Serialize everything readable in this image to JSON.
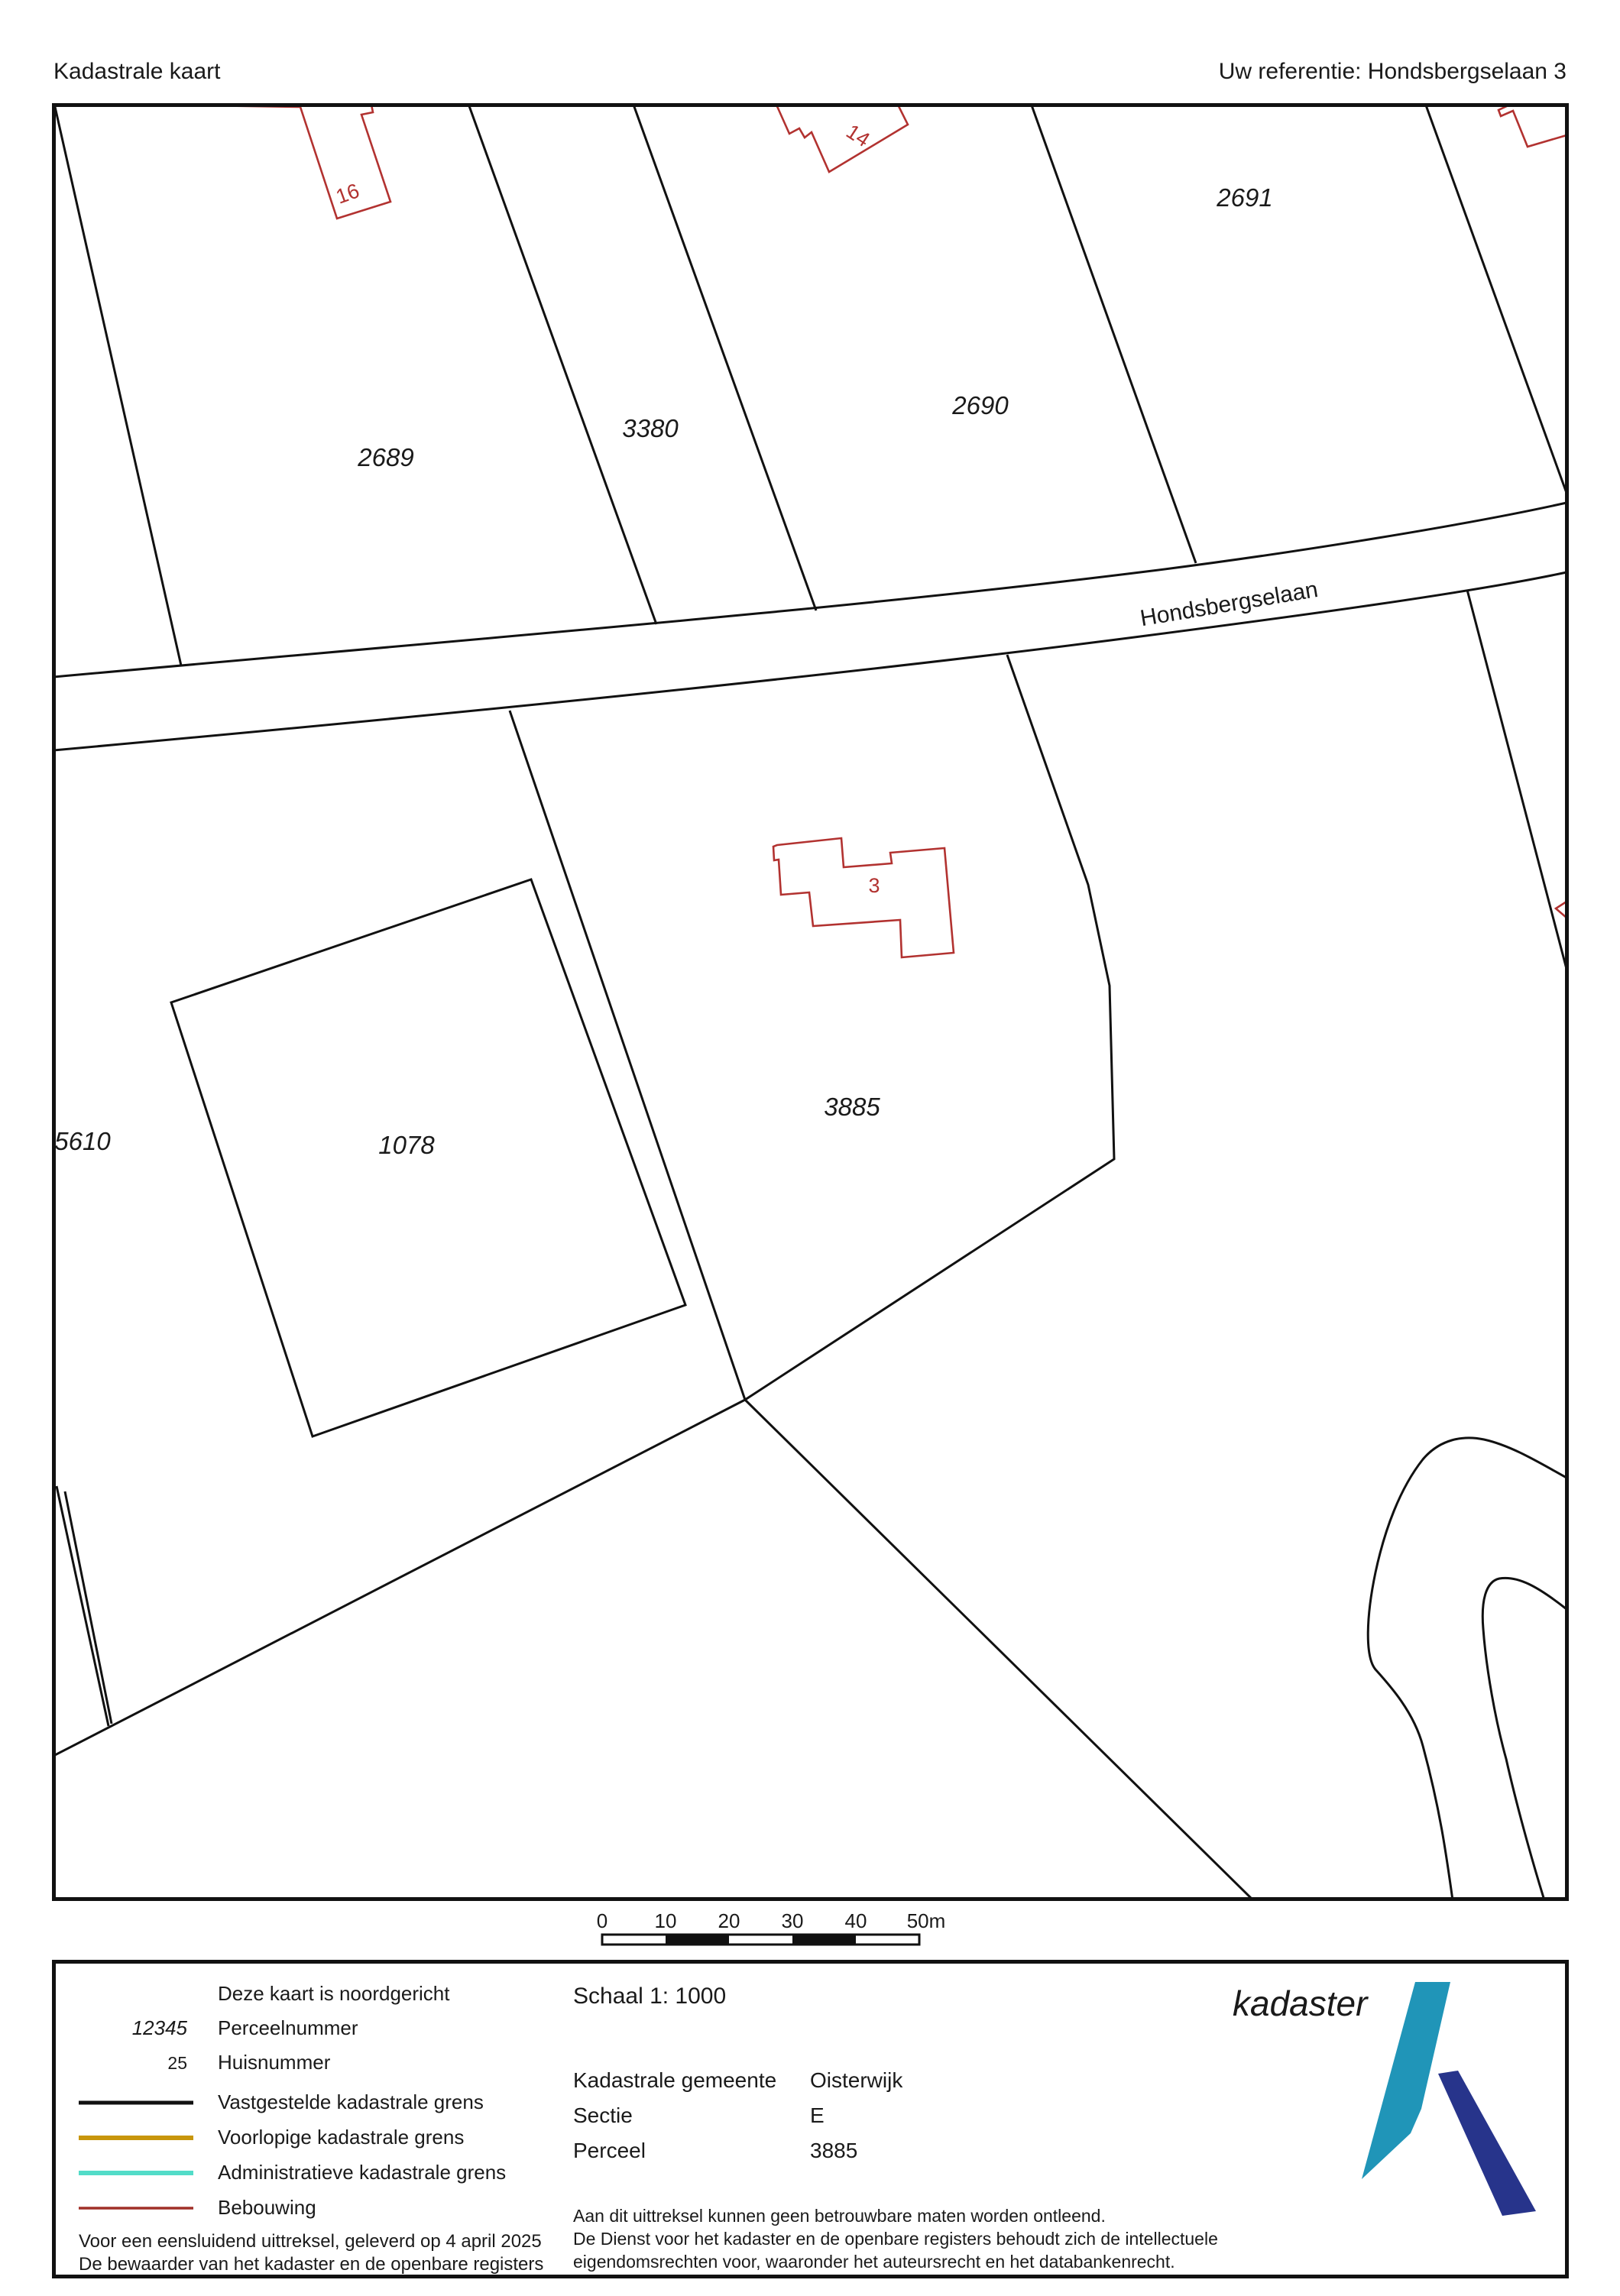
{
  "header": {
    "title": "Kadastrale kaart",
    "reference": "Uw referentie: Hondsbergselaan 3"
  },
  "map": {
    "road_label": "Hondsbergselaan",
    "parcels": [
      "2689",
      "3380",
      "2690",
      "2691",
      "3885",
      "1078",
      "5610"
    ],
    "house_numbers": [
      "16",
      "14",
      "3"
    ]
  },
  "scalebar": {
    "ticks": [
      "0",
      "10",
      "20",
      "30",
      "40",
      "50m"
    ]
  },
  "legend": {
    "north_note": "Deze kaart is noordgericht",
    "parcel_sample": "12345",
    "parcel_label": "Perceelnummer",
    "house_sample": "25",
    "house_label": "Huisnummer",
    "items": [
      {
        "label": "Vastgestelde kadastrale grens",
        "color": "#111111"
      },
      {
        "label": "Voorlopige kadastrale grens",
        "color": "#c8960c"
      },
      {
        "label": "Administratieve kadastrale grens",
        "color": "#52dcc8"
      },
      {
        "label": "Bebouwing",
        "color": "#a03028"
      }
    ],
    "footer_line1": "Voor een eensluidend uittreksel, geleverd op 4 april 2025",
    "footer_line2": "De bewaarder van het kadaster en de openbare registers"
  },
  "details": {
    "schaal": "Schaal 1: 1000",
    "rows": [
      {
        "label": "Kadastrale gemeente",
        "value": "Oisterwijk"
      },
      {
        "label": "Sectie",
        "value": "E"
      },
      {
        "label": "Perceel",
        "value": "3885"
      }
    ],
    "disclaimer": [
      "Aan dit uittreksel kunnen geen betrouwbare maten worden ontleend.",
      "De Dienst voor het kadaster en de openbare registers behoudt zich de intellectuele",
      "eigendomsrechten voor, waaronder het auteursrecht en het databankenrecht."
    ]
  },
  "logo": {
    "text": "kadaster",
    "light_blue": "#2095b8",
    "dark_blue": "#27348b"
  },
  "colors": {
    "boundary": "#111111",
    "building": "#b23230",
    "house_number": "#b23230"
  }
}
